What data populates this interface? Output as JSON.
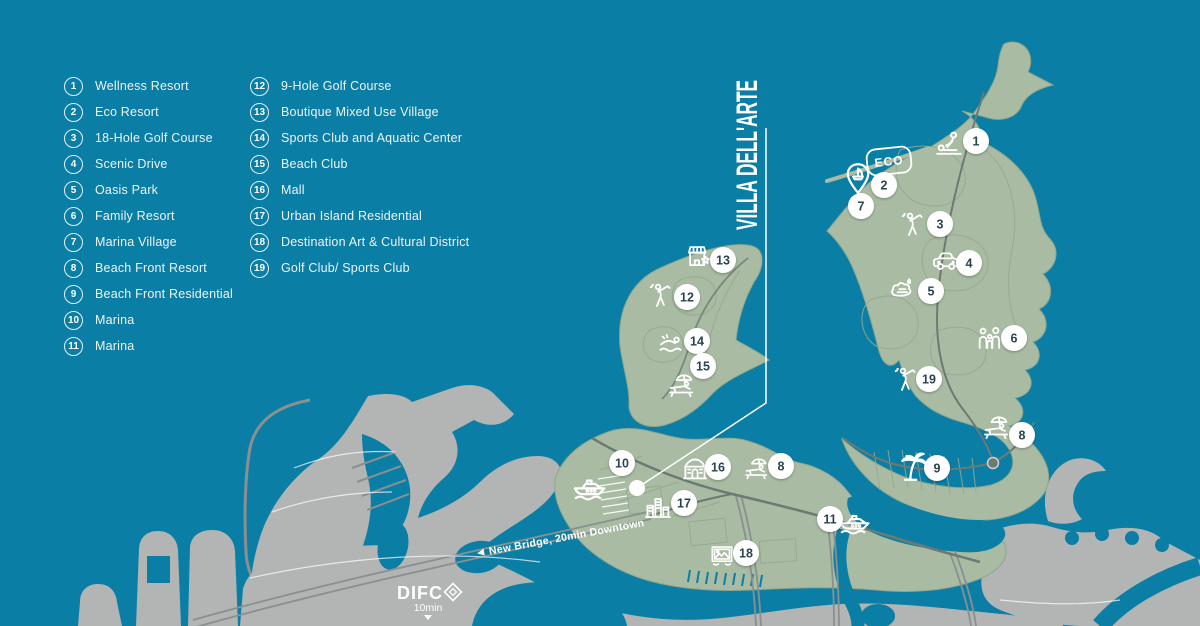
{
  "map_title": "VILLA DELL'ARTE",
  "badges": {
    "eco": "ECO"
  },
  "landmarks": {
    "difc": "DIFC",
    "difc_time": "10min",
    "bridge": "New Bridge, 20min Downtown"
  },
  "legend": {
    "columns": [
      {
        "items": [
          {
            "num": "1",
            "label": "Wellness Resort"
          },
          {
            "num": "2",
            "label": "Eco Resort"
          },
          {
            "num": "3",
            "label": "18-Hole Golf Course"
          },
          {
            "num": "4",
            "label": "Scenic Drive"
          },
          {
            "num": "5",
            "label": "Oasis Park"
          },
          {
            "num": "6",
            "label": "Family Resort"
          },
          {
            "num": "7",
            "label": "Marina Village"
          },
          {
            "num": "8",
            "label": "Beach Front Resort"
          },
          {
            "num": "9",
            "label": "Beach Front Residential"
          },
          {
            "num": "10",
            "label": "Marina"
          },
          {
            "num": "11",
            "label": "Marina"
          }
        ]
      },
      {
        "items": [
          {
            "num": "12",
            "label": "9-Hole Golf Course"
          },
          {
            "num": "13",
            "label": "Boutique Mixed Use Village"
          },
          {
            "num": "14",
            "label": "Sports Club and Aquatic Center"
          },
          {
            "num": "15",
            "label": "Beach Club"
          },
          {
            "num": "16",
            "label": "Mall"
          },
          {
            "num": "17",
            "label": "Urban Island Residential"
          },
          {
            "num": "18",
            "label": "Destination Art & Cultural District"
          },
          {
            "num": "19",
            "label": "Golf Club/ Sports Club"
          }
        ]
      }
    ]
  },
  "markers": [
    {
      "num": "1",
      "x": 976,
      "y": 141
    },
    {
      "num": "2",
      "x": 884,
      "y": 185
    },
    {
      "num": "7",
      "x": 861,
      "y": 206
    },
    {
      "num": "3",
      "x": 940,
      "y": 224
    },
    {
      "num": "4",
      "x": 969,
      "y": 263
    },
    {
      "num": "5",
      "x": 931,
      "y": 291
    },
    {
      "num": "6",
      "x": 1014,
      "y": 338
    },
    {
      "num": "19",
      "x": 929,
      "y": 379
    },
    {
      "num": "8",
      "x": 1022,
      "y": 435
    },
    {
      "num": "9",
      "x": 937,
      "y": 468
    },
    {
      "num": "13",
      "x": 723,
      "y": 260
    },
    {
      "num": "12",
      "x": 687,
      "y": 297
    },
    {
      "num": "14",
      "x": 697,
      "y": 341
    },
    {
      "num": "15",
      "x": 703,
      "y": 366
    },
    {
      "num": "10",
      "x": 622,
      "y": 463
    },
    {
      "num": "16",
      "x": 718,
      "y": 467
    },
    {
      "num": "8",
      "x": 781,
      "y": 466
    },
    {
      "num": "17",
      "x": 684,
      "y": 503
    },
    {
      "num": "11",
      "x": 830,
      "y": 519
    },
    {
      "num": "18",
      "x": 746,
      "y": 553
    }
  ],
  "map_icons": [
    {
      "name": "massage-icon",
      "x": 949,
      "y": 146,
      "s": 1.3
    },
    {
      "name": "pin-boat-icon",
      "x": 858,
      "y": 180,
      "s": 1.5
    },
    {
      "name": "golfer-icon",
      "x": 913,
      "y": 226,
      "s": 1.2
    },
    {
      "name": "car-icon",
      "x": 946,
      "y": 262,
      "s": 1.2
    },
    {
      "name": "oasis-icon",
      "x": 903,
      "y": 291,
      "s": 1.2
    },
    {
      "name": "family-icon",
      "x": 990,
      "y": 339,
      "s": 1.2
    },
    {
      "name": "golfer-icon",
      "x": 906,
      "y": 381,
      "s": 1.2
    },
    {
      "name": "lounger-icon",
      "x": 997,
      "y": 429,
      "s": 1.2
    },
    {
      "name": "palm-icon",
      "x": 911,
      "y": 467,
      "s": 1.5
    },
    {
      "name": "shop-icon",
      "x": 699,
      "y": 257,
      "s": 1.2
    },
    {
      "name": "golfer-icon",
      "x": 661,
      "y": 297,
      "s": 1.2
    },
    {
      "name": "swimmer-icon",
      "x": 672,
      "y": 346,
      "s": 1.2
    },
    {
      "name": "lounger-icon",
      "x": 682,
      "y": 387,
      "s": 1.2
    },
    {
      "name": "yacht-icon",
      "x": 590,
      "y": 486,
      "s": 1.5
    },
    {
      "name": "mall-icon",
      "x": 695,
      "y": 470,
      "s": 1.2
    },
    {
      "name": "lounger-icon",
      "x": 757,
      "y": 470,
      "s": 1.1
    },
    {
      "name": "buildings-icon",
      "x": 658,
      "y": 508,
      "s": 1.2
    },
    {
      "name": "yacht-icon",
      "x": 855,
      "y": 521,
      "s": 1.4
    },
    {
      "name": "frame-icon",
      "x": 722,
      "y": 555,
      "s": 1.1
    }
  ],
  "colors": {
    "sea": "#0B7EA6",
    "island": "#A9BCA3",
    "island_line": "#8FA78C",
    "land": "#B2B5B3",
    "land_road": "#8A908F",
    "green_road": "#6D7A74",
    "parcel": "#93A990",
    "marker_text": "#2A4450",
    "white": "#FFFFFF"
  }
}
